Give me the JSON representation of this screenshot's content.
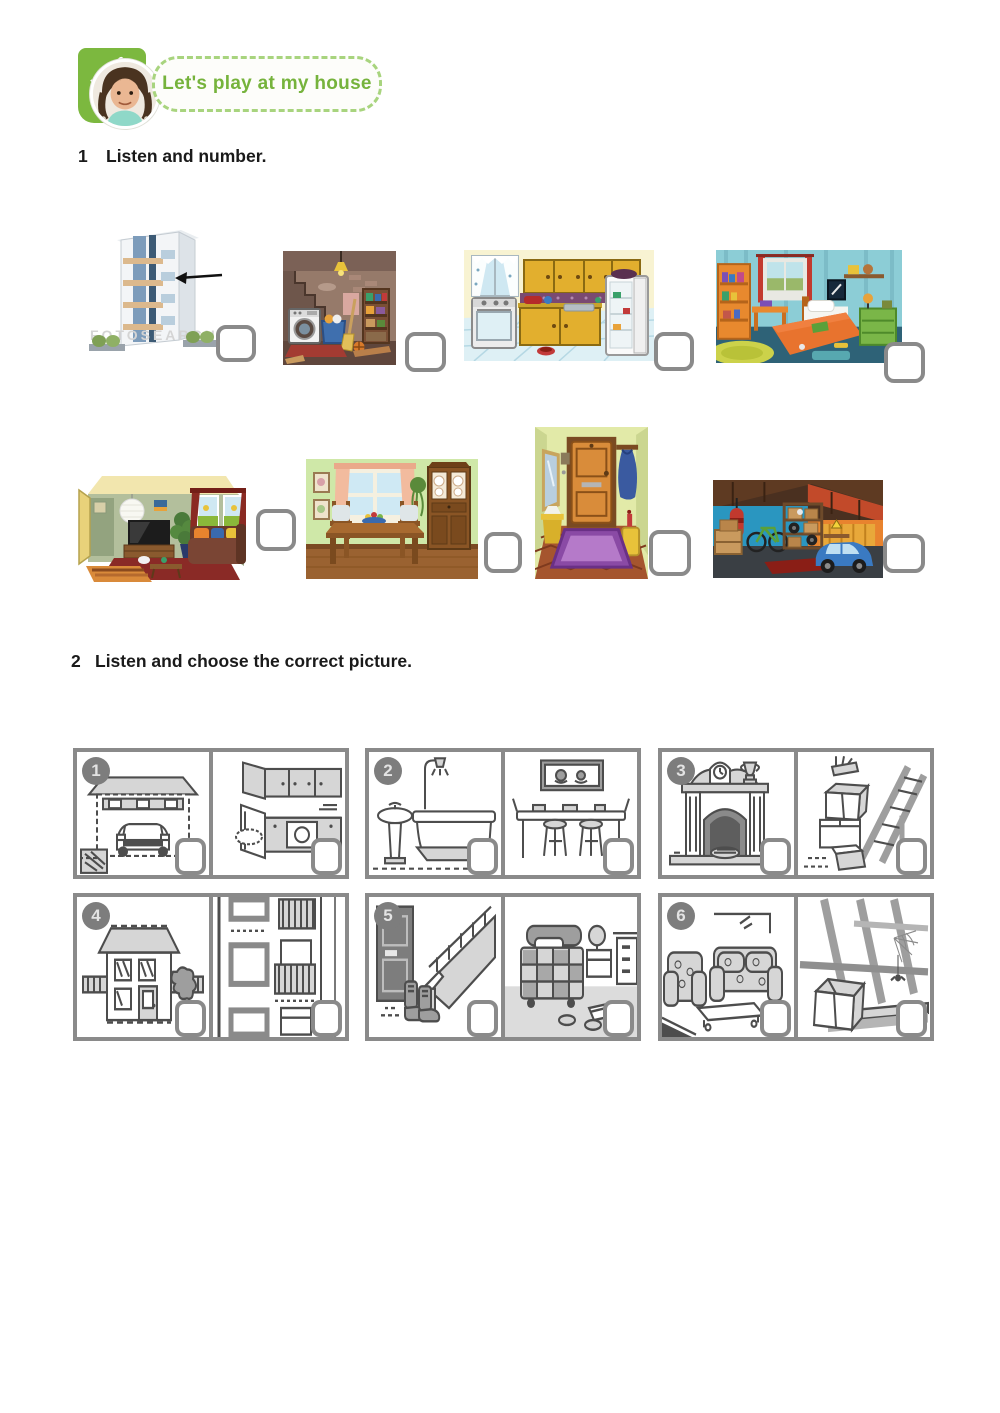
{
  "header": {
    "unit_label": "Unit 2",
    "title": "Let's play at my house"
  },
  "exercise1": {
    "number": "1",
    "instruction": "Listen and number.",
    "images": [
      {
        "name": "apartment-building",
        "watermark": "FOTOSEARCH"
      },
      {
        "name": "basement"
      },
      {
        "name": "kitchen"
      },
      {
        "name": "bedroom"
      },
      {
        "name": "living-room"
      },
      {
        "name": "dining-room"
      },
      {
        "name": "hallway"
      },
      {
        "name": "garage"
      }
    ]
  },
  "exercise2": {
    "number": "2",
    "instruction": "Listen and choose the correct picture.",
    "pairs": [
      {
        "number": "1",
        "left": "garage-with-car",
        "right": "kitchen"
      },
      {
        "number": "2",
        "left": "bathroom",
        "right": "dining-room"
      },
      {
        "number": "3",
        "left": "fireplace",
        "right": "attic-ladder"
      },
      {
        "number": "4",
        "left": "detached-house",
        "right": "apartment-block"
      },
      {
        "number": "5",
        "left": "staircase-hall",
        "right": "bedroom"
      },
      {
        "number": "6",
        "left": "living-room",
        "right": "attic"
      }
    ]
  },
  "colors": {
    "accent_green": "#7cb83f",
    "answer_box_border": "#8a8a8a",
    "badge_gray": "#7d7d7d"
  }
}
